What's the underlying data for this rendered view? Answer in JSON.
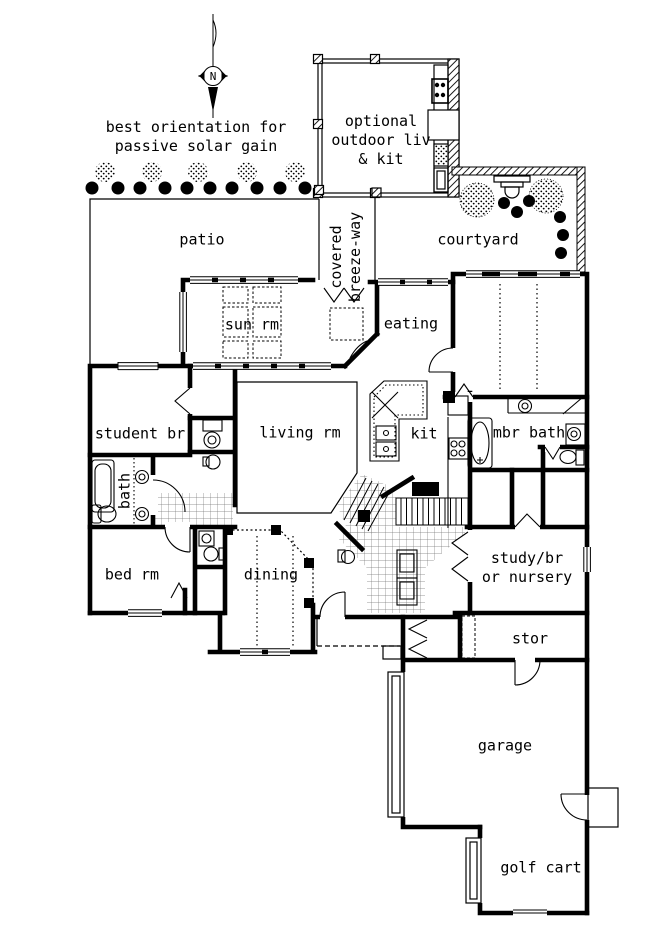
{
  "plan": {
    "compass_n": "N",
    "note": "best orientation for\npassive solar gain",
    "rooms": {
      "outdoor": "optional\noutdoor liv\n& kit",
      "patio": "patio",
      "courtyard": "courtyard",
      "breezeway": "covered\nbreeze-way",
      "sun_rm": "sun rm",
      "eating": "eating",
      "student_br": "student br",
      "living_rm": "living rm",
      "kit": "kit",
      "mbr_bath": "mbr bath",
      "bath": "bath",
      "bed_rm": "bed rm",
      "dining": "dining",
      "study": "study/br\nor nursery",
      "stor": "stor",
      "garage": "garage",
      "golf_cart": "golf cart"
    }
  }
}
